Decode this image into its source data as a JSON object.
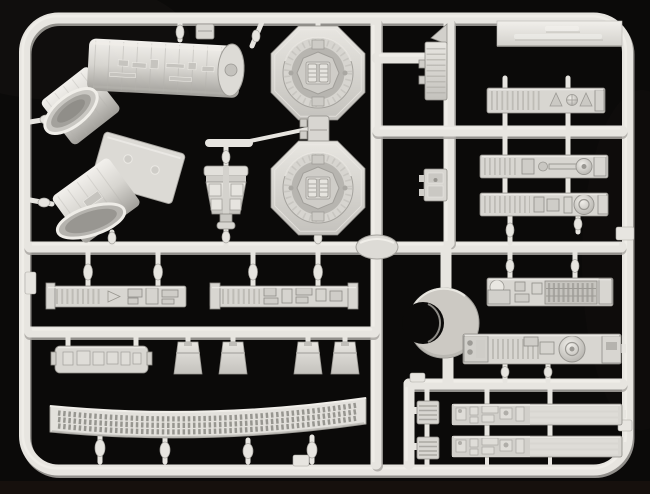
{
  "scene": {
    "type": "photograph",
    "description": "Light gray injection-molded plastic model kit sprue (parts runner) photographed on a black background",
    "colors": {
      "bg": "#0b0a09",
      "bg_warm": "#201510",
      "plastic": "#d8d6d1",
      "plastic_light": "#f0eee9",
      "plastic_shade": "#b2b0ab",
      "plastic_dark": "#8e8c87",
      "runner": "#e7e5e0",
      "runner_shadow": "#a9a7a2",
      "recess": "#c0beb9"
    }
  },
  "sprue": {
    "frame": {
      "shape": "Rounded-rectangle outer runner frame with cross runners",
      "marking_tab": "Flat tab on the top-right rail with faint embossed lettering (illegible)",
      "injection_node": "Lens-shaped sprue node at the central runner junction"
    },
    "part_count_visible": 27,
    "parts": [
      {
        "id": "tube-half-a",
        "label": "Large angled cylindrical tube half with surface piping detail (upper left)"
      },
      {
        "id": "tube-half-b",
        "label": "Second angled tube half with flat mating face and two locating pins"
      },
      {
        "id": "gunner-seat",
        "label": "Small seat-shaped part with four square back pads"
      },
      {
        "id": "turret-ring-a",
        "label": "Octagonal ring with recessed circular hub detail (upper)"
      },
      {
        "id": "spacer-block",
        "label": "Small rectangular block between the two octagonal rings"
      },
      {
        "id": "turret-ring-b",
        "label": "Octagonal ring with recessed circular hub detail (lower)"
      },
      {
        "id": "ribbed-wedge",
        "label": "Narrow ribbed wedge with pointed fin right of the octagons"
      },
      {
        "id": "relay-box",
        "label": "Small rectangular detail box on the right vertical runner"
      },
      {
        "id": "greeble-strip-a",
        "label": "Detailed strip with slots, twin triangular fittings and a round dial"
      },
      {
        "id": "greeble-strip-b",
        "label": "Detailed strip with ribbed end, piping and piston disc"
      },
      {
        "id": "greeble-strip-c",
        "label": "Detailed strip with ribbed end and large concentric disc"
      },
      {
        "id": "ring-segment",
        "label": "Thick C-shaped ring segment (crescent)"
      },
      {
        "id": "machinery-strip-a",
        "label": "Machinery strip with dome, waffle-grid panel and end block"
      },
      {
        "id": "machinery-strip-b",
        "label": "Machinery strip with twin rivets, large wheel disc and end bracket"
      },
      {
        "id": "sidewall-strip-a",
        "label": "Long detailed sidewall strip with chevron greeble (left)"
      },
      {
        "id": "sidewall-strip-b",
        "label": "Long detailed sidewall strip (right)"
      },
      {
        "id": "detail-plate",
        "label": "Flat plate with a row of raised rectangular blocks"
      },
      {
        "id": "foot-pad-1",
        "label": "Tapered trapezoidal foot pad 1"
      },
      {
        "id": "foot-pad-2",
        "label": "Tapered trapezoidal foot pad 2"
      },
      {
        "id": "foot-pad-3",
        "label": "Tapered trapezoidal foot pad 3"
      },
      {
        "id": "foot-pad-4",
        "label": "Tapered trapezoidal foot pad 4"
      },
      {
        "id": "exhaust-grille",
        "label": "Long gently curved grille with three rows of vent slots"
      },
      {
        "id": "detail-box-a",
        "label": "Small louvered box, bottom-right upper row"
      },
      {
        "id": "rail-strip-a",
        "label": "Long strip with detailed head and three parallel rails, upper row"
      },
      {
        "id": "detail-box-b",
        "label": "Small louvered box, bottom-right lower row"
      },
      {
        "id": "rail-strip-b",
        "label": "Long strip with detailed head and three parallel rails, lower row"
      },
      {
        "id": "rail-block",
        "label": "Small block hanging from the top rail"
      }
    ]
  }
}
